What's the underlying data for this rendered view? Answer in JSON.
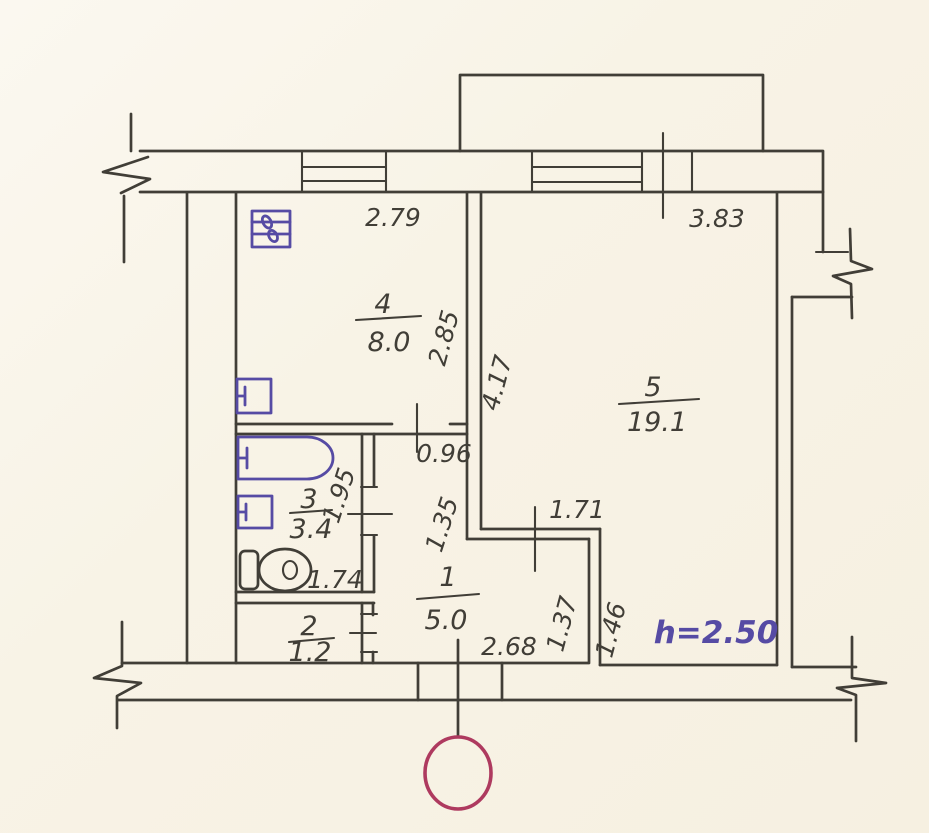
{
  "plan": {
    "rooms": [
      {
        "number": "1",
        "area": "5.0"
      },
      {
        "number": "2",
        "area": "1.2"
      },
      {
        "number": "3",
        "area": "3.4"
      },
      {
        "number": "4",
        "area": "8.0"
      },
      {
        "number": "5",
        "area": "19.1"
      }
    ],
    "dimensions": {
      "kitchen_width": "2.79",
      "kitchen_depth": "2.85",
      "living_width": "3.83",
      "living_depth": "4.17",
      "corridor_width": "0.96",
      "corridor_length": "1.35",
      "nook_width": "1.71",
      "nook_depth_left": "1.37",
      "nook_depth_right": "1.46",
      "bathroom_depth": "1.95",
      "bathroom_width": "1.74",
      "hallway_width": "2.68",
      "ceiling_height": "h=2.50"
    },
    "icons": [
      "stove-icon",
      "kitchen-sink-icon",
      "bathtub-icon",
      "washbasin-icon",
      "toilet-icon",
      "entrance-marker-icon",
      "wall-break-icon",
      "window-icon"
    ],
    "colors": {
      "ink": "#413e37",
      "blue_ink": "#564ba4",
      "red_ink": "#ae3a5f",
      "paper": "#f8f3e8"
    }
  }
}
